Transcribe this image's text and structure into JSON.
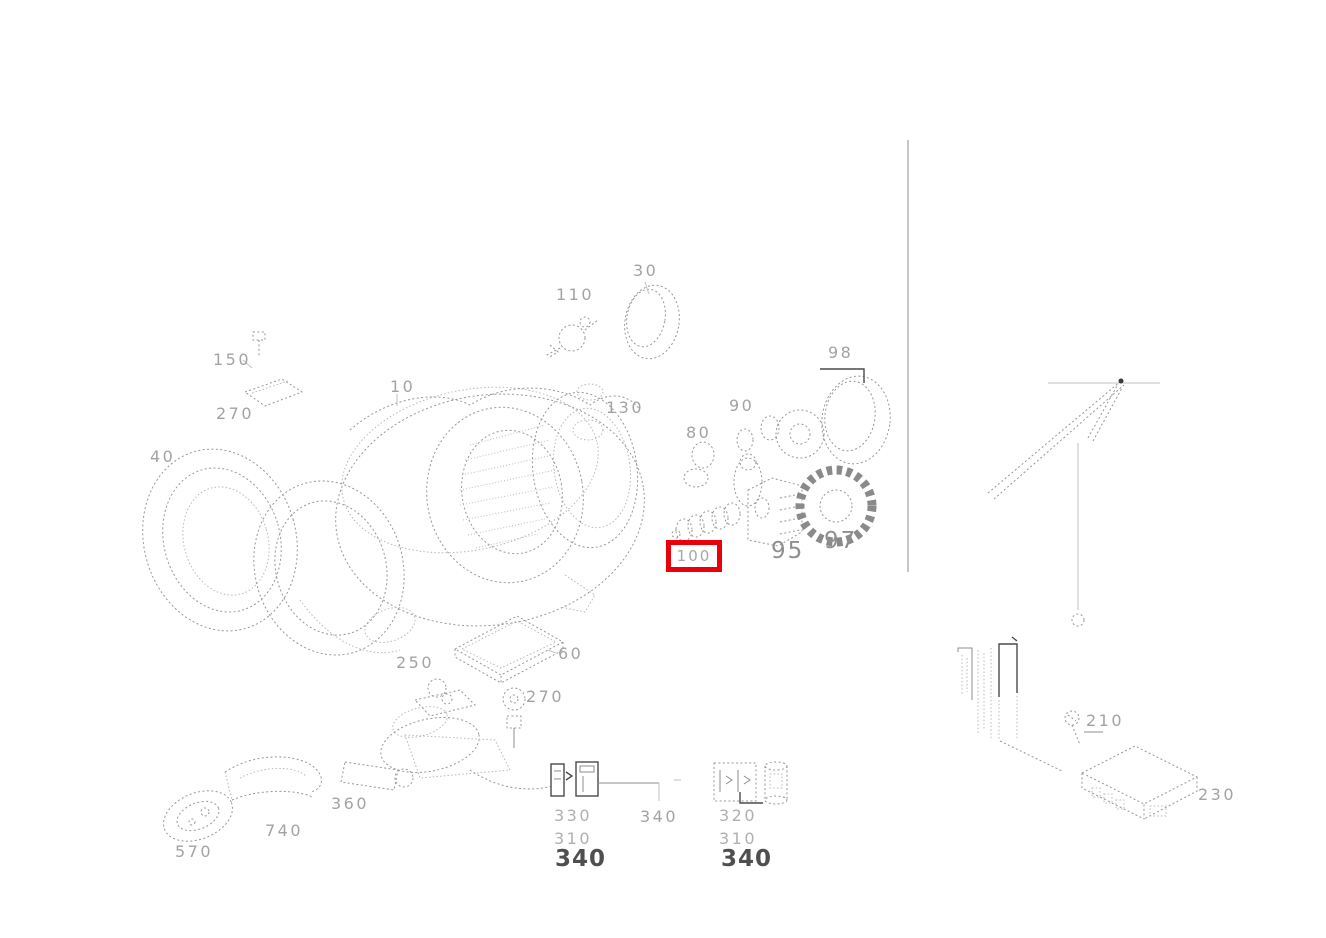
{
  "colors": {
    "highlight_red": "#e8000b",
    "label_gray": "#a3a3a3",
    "label_dark": "#4f4f4f",
    "line_gray": "#979797"
  },
  "highlight": {
    "label": "100"
  },
  "part_labels": {
    "p30": "30",
    "p110": "110",
    "p130": "130",
    "p10": "10",
    "p150": "150",
    "p270a": "270",
    "p40": "40",
    "p98": "98",
    "p90": "90",
    "p80": "80",
    "p95": "95",
    "p97": "97",
    "p60": "60",
    "p250": "250",
    "p270b": "270",
    "p740": "740",
    "p570": "570",
    "p360": "360",
    "left_col": {
      "r1": "330",
      "r2": "310",
      "r3": "340"
    },
    "mid340": "340",
    "right_col": {
      "r1": "320",
      "r2": "310",
      "r3": "340"
    },
    "p210": "210",
    "p230": "230"
  }
}
